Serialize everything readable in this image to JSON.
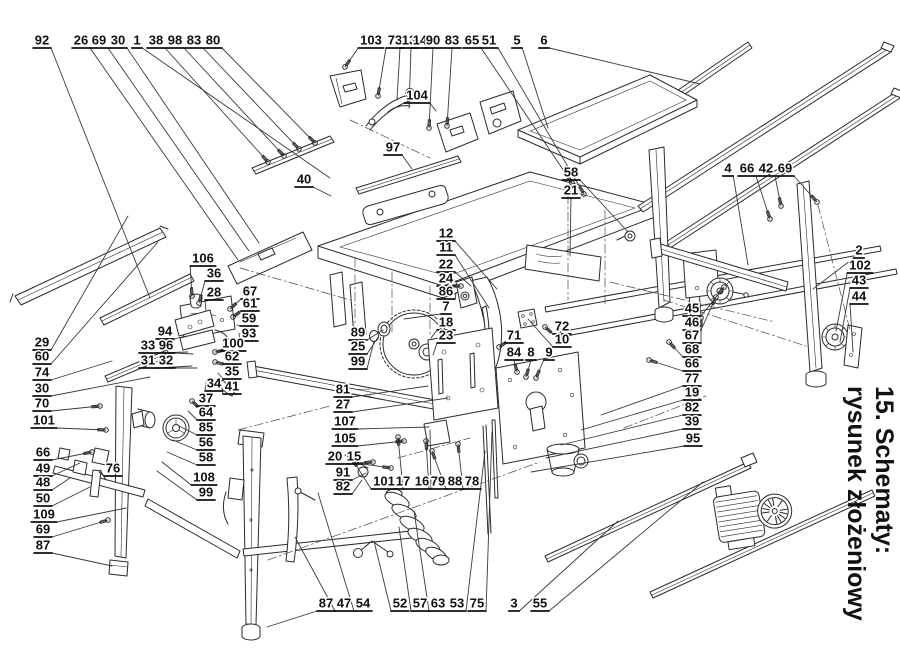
{
  "title": {
    "line1": "15. Schematy:",
    "line2": "rysunek złożeniowy"
  },
  "colors": {
    "ink": "#101010",
    "line": "#2b2b2b",
    "background": "#ffffff"
  },
  "labels_columns": [
    "part_number",
    "label_x",
    "label_y",
    "target_x",
    "target_y",
    "has_hardware_glyph"
  ],
  "labels": [
    [
      "92",
      42,
      40,
      150,
      298,
      0
    ],
    [
      "26",
      81,
      40,
      238,
      260,
      0
    ],
    [
      "69",
      99,
      40,
      249,
      251,
      0
    ],
    [
      "30",
      118,
      40,
      259,
      243,
      0
    ],
    [
      "1",
      137,
      40,
      330,
      178,
      0
    ],
    [
      "38",
      156,
      40,
      268,
      162,
      1
    ],
    [
      "98",
      175,
      40,
      284,
      156,
      1
    ],
    [
      "83",
      194,
      40,
      299,
      149,
      1
    ],
    [
      "80",
      213,
      40,
      315,
      143,
      1
    ],
    [
      "103",
      371,
      40,
      345,
      67,
      1
    ],
    [
      "73",
      395,
      40,
      378,
      96,
      1
    ],
    [
      "13",
      409,
      40,
      397,
      100,
      0
    ],
    [
      "14",
      420,
      40,
      409,
      108,
      0
    ],
    [
      "90",
      433,
      40,
      429,
      128,
      1
    ],
    [
      "83",
      452,
      40,
      447,
      126,
      1
    ],
    [
      "65",
      472,
      40,
      572,
      183,
      1
    ],
    [
      "51",
      489,
      40,
      584,
      194,
      1
    ],
    [
      "5",
      517,
      40,
      548,
      128,
      0
    ],
    [
      "6",
      544,
      40,
      700,
      84,
      0
    ],
    [
      "104",
      417,
      95,
      436,
      111,
      0
    ],
    [
      "97",
      393,
      147,
      412,
      169,
      0
    ],
    [
      "40",
      304,
      179,
      331,
      196,
      0
    ],
    [
      "58",
      571,
      172,
      628,
      232,
      0
    ],
    [
      "21",
      571,
      190,
      570,
      256,
      0
    ],
    [
      "4",
      728,
      168,
      748,
      265,
      0
    ],
    [
      "66",
      747,
      168,
      770,
      219,
      1
    ],
    [
      "42",
      766,
      168,
      781,
      206,
      1
    ],
    [
      "69",
      785,
      168,
      817,
      202,
      1
    ],
    [
      "2",
      859,
      250,
      813,
      289,
      0
    ],
    [
      "102",
      860,
      265,
      836,
      331,
      0
    ],
    [
      "43",
      859,
      280,
      840,
      342,
      0
    ],
    [
      "44",
      859,
      296,
      853,
      352,
      0
    ],
    [
      "45",
      692,
      308,
      724,
      287,
      1
    ],
    [
      "46",
      692,
      322,
      716,
      297,
      1
    ],
    [
      "67",
      692,
      335,
      701,
      318,
      1
    ],
    [
      "68",
      692,
      349,
      669,
      342,
      1
    ],
    [
      "66",
      692,
      363,
      649,
      360,
      1
    ],
    [
      "77",
      692,
      378,
      601,
      415,
      0
    ],
    [
      "19",
      692,
      392,
      581,
      430,
      0
    ],
    [
      "82",
      692,
      407,
      561,
      445,
      0
    ],
    [
      "39",
      692,
      421,
      546,
      458,
      0
    ],
    [
      "95",
      693,
      438,
      531,
      472,
      0
    ],
    [
      "29",
      42,
      342,
      128,
      216,
      0
    ],
    [
      "60",
      42,
      356,
      158,
      242,
      0
    ],
    [
      "74",
      42,
      372,
      112,
      361,
      0
    ],
    [
      "30",
      42,
      388,
      150,
      377,
      0
    ],
    [
      "70",
      42,
      403,
      100,
      406,
      1
    ],
    [
      "101",
      44,
      420,
      106,
      430,
      1
    ],
    [
      "66",
      43,
      452,
      92,
      452,
      1
    ],
    [
      "49",
      43,
      468,
      80,
      463,
      0
    ],
    [
      "76",
      113,
      468,
      99,
      472,
      0
    ],
    [
      "48",
      43,
      482,
      70,
      478,
      0
    ],
    [
      "50",
      43,
      498,
      90,
      487,
      0
    ],
    [
      "109",
      44,
      514,
      126,
      508,
      0
    ],
    [
      "69",
      43,
      529,
      108,
      520,
      1
    ],
    [
      "87",
      43,
      545,
      112,
      566,
      0
    ],
    [
      "106",
      203,
      258,
      192,
      296,
      1
    ],
    [
      "36",
      214,
      273,
      199,
      303,
      1
    ],
    [
      "28",
      214,
      292,
      206,
      311,
      0
    ],
    [
      "67",
      250,
      291,
      230,
      309,
      1
    ],
    [
      "61",
      250,
      303,
      233,
      317,
      1
    ],
    [
      "59",
      249,
      318,
      237,
      325,
      0
    ],
    [
      "93",
      249,
      333,
      239,
      333,
      0
    ],
    [
      "94",
      165,
      331,
      186,
      336,
      0
    ],
    [
      "33",
      148,
      345,
      188,
      352,
      0
    ],
    [
      "96",
      166,
      345,
      193,
      354,
      0
    ],
    [
      "31",
      148,
      360,
      192,
      366,
      0
    ],
    [
      "32",
      166,
      360,
      197,
      368,
      0
    ],
    [
      "100",
      233,
      343,
      215,
      352,
      1
    ],
    [
      "62",
      232,
      356,
      215,
      362,
      1
    ],
    [
      "35",
      232,
      371,
      218,
      373,
      0
    ],
    [
      "34",
      214,
      383,
      206,
      381,
      0
    ],
    [
      "41",
      232,
      386,
      222,
      390,
      0
    ],
    [
      "37",
      206,
      398,
      192,
      401,
      1
    ],
    [
      "64",
      206,
      412,
      188,
      411,
      0
    ],
    [
      "85",
      206,
      427,
      179,
      426,
      0
    ],
    [
      "56",
      206,
      442,
      173,
      440,
      0
    ],
    [
      "58",
      206,
      457,
      167,
      452,
      0
    ],
    [
      "108",
      204,
      477,
      162,
      462,
      0
    ],
    [
      "99",
      206,
      492,
      157,
      471,
      0
    ],
    [
      "12",
      446,
      233,
      497,
      289,
      0
    ],
    [
      "11",
      446,
      247,
      489,
      308,
      0
    ],
    [
      "22",
      446,
      264,
      471,
      286,
      0
    ],
    [
      "24",
      446,
      278,
      461,
      286,
      1
    ],
    [
      "86",
      446,
      291,
      456,
      293,
      0
    ],
    [
      "7",
      446,
      306,
      404,
      319,
      0
    ],
    [
      "18",
      446,
      322,
      431,
      338,
      0
    ],
    [
      "23",
      446,
      335,
      433,
      355,
      0
    ],
    [
      "89",
      358,
      332,
      383,
      330,
      0
    ],
    [
      "25",
      358,
      346,
      379,
      336,
      0
    ],
    [
      "99",
      358,
      361,
      374,
      341,
      0
    ],
    [
      "72",
      562,
      326,
      545,
      327,
      1
    ],
    [
      "10",
      562,
      339,
      528,
      319,
      0
    ],
    [
      "71",
      514,
      335,
      499,
      347,
      1
    ],
    [
      "84",
      514,
      352,
      517,
      372,
      1
    ],
    [
      "8",
      531,
      352,
      526,
      377,
      1
    ],
    [
      "9",
      549,
      352,
      536,
      378,
      1
    ],
    [
      "81",
      343,
      389,
      428,
      386,
      0
    ],
    [
      "27",
      343,
      404,
      448,
      398,
      0
    ],
    [
      "107",
      345,
      421,
      429,
      427,
      0
    ],
    [
      "105",
      345,
      438,
      404,
      441,
      1
    ],
    [
      "20",
      335,
      456,
      373,
      462,
      1
    ],
    [
      "15",
      354,
      456,
      391,
      468,
      1
    ],
    [
      "91",
      343,
      472,
      366,
      473,
      0
    ],
    [
      "82",
      343,
      486,
      362,
      480,
      0
    ],
    [
      "101",
      384,
      481,
      352,
      459,
      1
    ],
    [
      "17",
      403,
      481,
      398,
      437,
      1
    ],
    [
      "16",
      422,
      481,
      430,
      430,
      0
    ],
    [
      "79",
      438,
      481,
      426,
      441,
      1
    ],
    [
      "88",
      455,
      481,
      432,
      451,
      1
    ],
    [
      "78",
      472,
      481,
      458,
      444,
      1
    ],
    [
      "87",
      326,
      603,
      267,
      627,
      0
    ],
    [
      "47",
      344,
      603,
      295,
      537,
      0
    ],
    [
      "54",
      363,
      603,
      318,
      493,
      0
    ],
    [
      "52",
      400,
      603,
      374,
      541,
      0
    ],
    [
      "57",
      420,
      603,
      399,
      527,
      0
    ],
    [
      "63",
      438,
      603,
      414,
      511,
      0
    ],
    [
      "53",
      457,
      603,
      485,
      451,
      0
    ],
    [
      "75",
      477,
      603,
      492,
      432,
      0
    ],
    [
      "3",
      514,
      603,
      618,
      521,
      0
    ],
    [
      "55",
      540,
      603,
      703,
      482,
      0
    ]
  ]
}
